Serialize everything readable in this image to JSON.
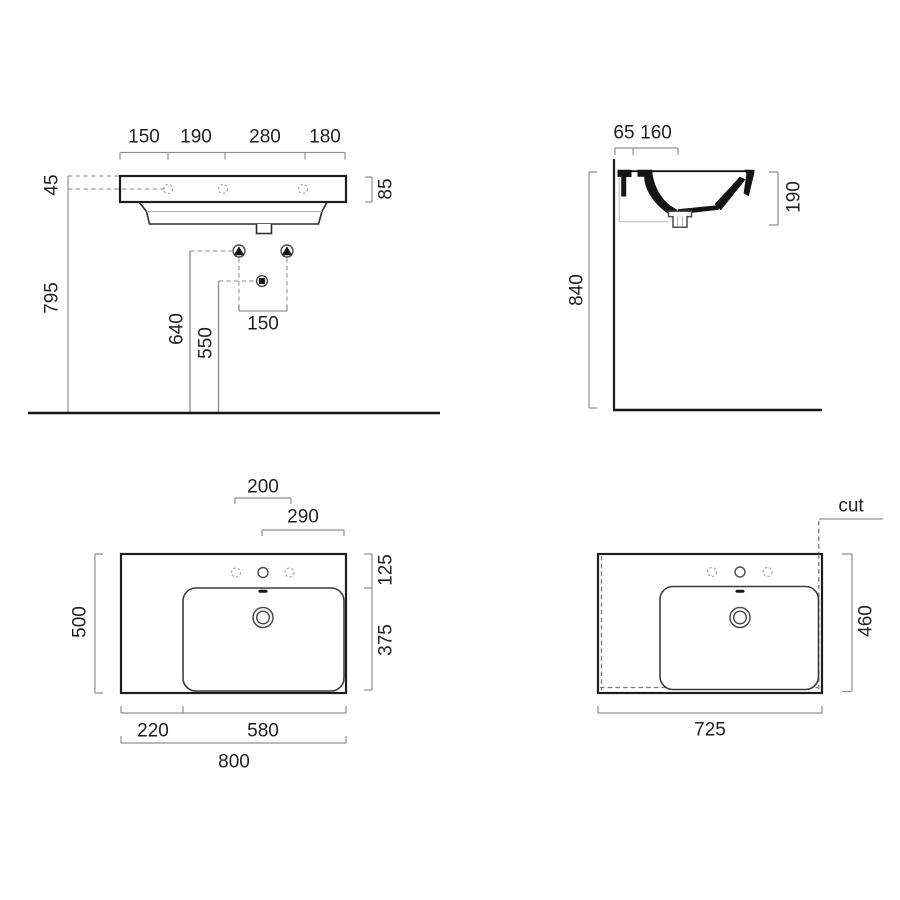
{
  "drawing_title": "wall-hung washbasin dimension drawing",
  "colors": {
    "line": "#231f20",
    "dimension": "#8d9093",
    "background": "#ffffff"
  },
  "views": {
    "front_elevation": {
      "width_segments": [
        "150",
        "190",
        "280",
        "180"
      ],
      "rim_to_holes": "45",
      "holes_height": "795",
      "rim_thickness": "85",
      "bracket_height": "640",
      "drain_height": "550",
      "mount_spacing": "150"
    },
    "side_section": {
      "depth_segments": [
        "65",
        "160"
      ],
      "total_height": "840",
      "basin_depth": "190"
    },
    "plan_full": {
      "hole_offset": "200",
      "bowl_offset": "290",
      "depth": "500",
      "front_depth": "125",
      "bowl_depth": "375",
      "left_ledge": "220",
      "bowl_width": "580",
      "total_width": "800"
    },
    "plan_cut": {
      "cut_label": "cut",
      "cut_width": "725",
      "cut_depth": "460"
    }
  }
}
